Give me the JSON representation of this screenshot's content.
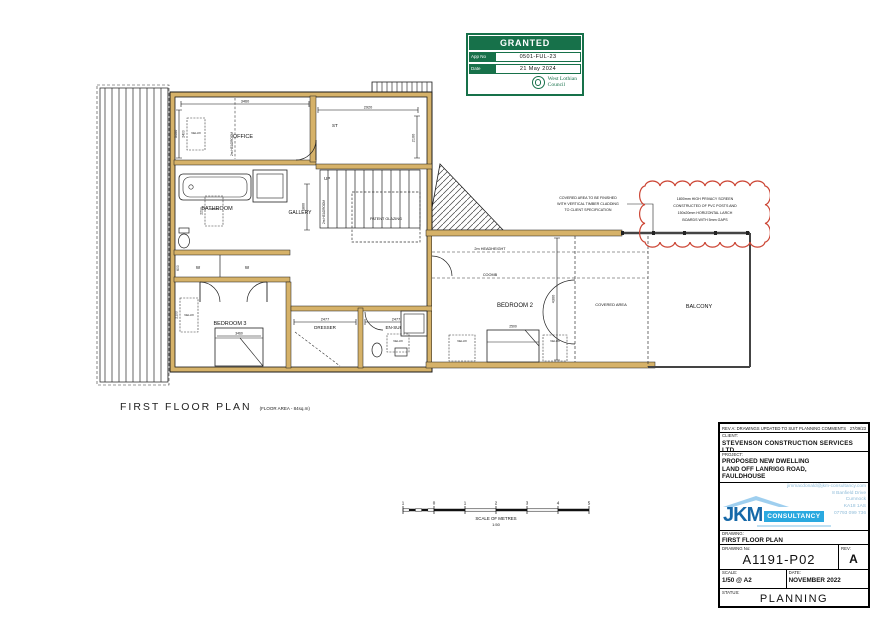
{
  "stamp": {
    "title": "GRANTED",
    "app_no_label": "App No",
    "app_no": "0501-FUL-23",
    "date_label": "Date",
    "date": "21 May 2024",
    "council_line1": "West Lothian",
    "council_line2": "Council"
  },
  "plan": {
    "title": "FIRST FLOOR PLAN",
    "area_note": "(FLOOR AREA - 84sq.m)",
    "labels": {
      "office": "OFFICE",
      "bathroom": "BATHROOM",
      "gallery": "GALLERY",
      "store": "ST",
      "up": "UP",
      "patent_glazing": "PATENT GLAZING",
      "bedroom2": "BEDROOM 2",
      "bedroom3": "BEDROOM 3",
      "dresser": "DRESSER",
      "ensuite": "EN-SUITE",
      "balcony": "BALCONY",
      "covered_area": "COVERED AREA",
      "wardrobe": "W",
      "velux": "VELUX",
      "headheight": "2m HEADHEIGHT",
      "headroom": "2m HEADROOM",
      "coomb": "COOMB"
    },
    "dims": {
      "office_top": "3460",
      "office_left": "3400",
      "office_velux": "2400",
      "landing_top": "2920",
      "landing_side": "2100",
      "bath_velux": "2200",
      "wardrobe": "600",
      "gallery": "1800",
      "bed3_velux": "2100",
      "bed3_width": "3460",
      "dresser_width": "2477",
      "ensuite_width": "2477",
      "bed2_height": "4300",
      "bed2_width": "2500"
    },
    "notes": {
      "covered": [
        "COVERED AREA TO BE FINISHED",
        "WITH VERTICAL TIMBER CLADDING",
        "TO CLIENT SPECIFICATION"
      ],
      "privacy": [
        "1800mm HIGH PRIVACY SCREEN",
        "CONSTRUCTED OF PVC POSTS AND",
        "150x20mm HORIZONTAL LARCH",
        "BOARDS WITH 5mm GAPS"
      ]
    }
  },
  "scalebar": {
    "ticks": [
      "1",
      "0",
      "1",
      "2",
      "3",
      "4",
      "5"
    ],
    "label": "SCALE OF METRES",
    "ratio": "1:50"
  },
  "titleblock": {
    "rev_note": "REV A: DRAWINGS UPDATED TO SUIT PLANNING COMMENTS",
    "rev_note_date": "27/09/23",
    "client_label": "CLIENT:",
    "client": "STEVENSON CONSTRUCTION SERVICES LTD",
    "project_label": "PROJECT:",
    "project_line1": "PROPOSED NEW DWELLING",
    "project_line2": "LAND OFF LANRIGG ROAD,",
    "project_line3": "FAULDHOUSE",
    "logo_jkm": "JKM",
    "logo_consultancy": "CONSULTANCY",
    "email": "jimmacdonald@jkm-consultancy.com",
    "address1": "8 Banfield Drive",
    "address2": "Cumnock",
    "address3": "KA18 1AS",
    "phone": "07793 099 736",
    "drawing_label": "DRAWING:",
    "drawing": "FIRST FLOOR PLAN",
    "drawing_no_label": "DRAWING No:",
    "drawing_no": "A1191-P02",
    "rev_label": "REV:",
    "rev": "A",
    "scale_label": "SCALE:",
    "scale": "1/50 @ A2",
    "date_label": "DATE:",
    "date": "NOVEMBER 2022",
    "status_label": "STATUS:",
    "status": "PLANNING"
  },
  "colors": {
    "wall_tan": "#d6b269",
    "stamp_green": "#17714a",
    "jkm_blue": "#1668a8",
    "jkm_bar_blue": "#2aa9e0",
    "cloud_red": "#cc4433"
  }
}
